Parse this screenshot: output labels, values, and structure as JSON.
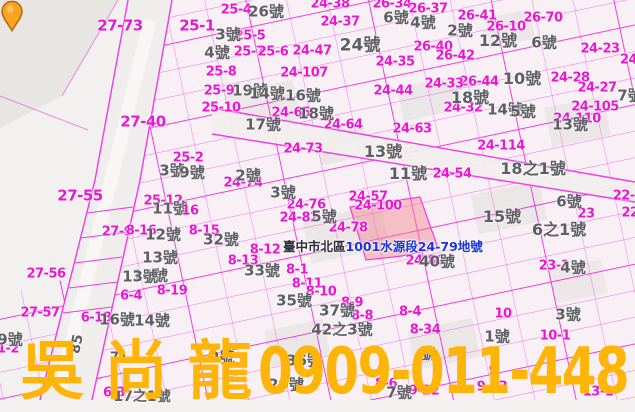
{
  "app": {
    "description": "cadastral map viewer"
  },
  "callout": {
    "prefix": "臺中市北區",
    "lot": "1001水源段24-79地號"
  },
  "watermark": {
    "name": "吳尚龍",
    "phone": "0909-011-448"
  },
  "colors": {
    "line": "#f23ae8",
    "street_line": "#ea21dc",
    "parcel_label": "#ec16d2",
    "house_label": "#5e5e64",
    "callout_blue": "#1a35da",
    "callout_dark": "#2c2c34",
    "watermark": "#ffb408",
    "pin_fill": "#f9a422",
    "pin_stroke": "#bf6708",
    "highlight_fill": "rgba(242,130,140,0.45)",
    "background": "#f3f1ef"
  },
  "map_labels": [
    {
      "t": "27-73",
      "x": 120,
      "y": 26,
      "c": "p",
      "s": 15
    },
    {
      "t": "25-1",
      "x": 197,
      "y": 26,
      "c": "p",
      "s": 15
    },
    {
      "t": "27-40",
      "x": 143,
      "y": 122,
      "c": "p",
      "s": 15
    },
    {
      "t": "27-55",
      "x": 80,
      "y": 196,
      "c": "p",
      "s": 15
    },
    {
      "t": "27-56",
      "x": 46,
      "y": 274,
      "c": "p"
    },
    {
      "t": "27-57",
      "x": 40,
      "y": 313,
      "c": "p"
    },
    {
      "t": "25-4",
      "x": 236,
      "y": 10,
      "c": "p"
    },
    {
      "t": "24-38",
      "x": 330,
      "y": 4,
      "c": "p"
    },
    {
      "t": "26-34",
      "x": 392,
      "y": 4,
      "c": "p"
    },
    {
      "t": "26-37",
      "x": 428,
      "y": 9,
      "c": "p"
    },
    {
      "t": "24-37",
      "x": 340,
      "y": 22,
      "c": "p"
    },
    {
      "t": "25-5",
      "x": 250,
      "y": 36,
      "c": "p"
    },
    {
      "t": "25-7",
      "x": 249,
      "y": 52,
      "c": "p"
    },
    {
      "t": "25-6",
      "x": 273,
      "y": 52,
      "c": "p"
    },
    {
      "t": "24-47",
      "x": 312,
      "y": 51,
      "c": "p"
    },
    {
      "t": "24-35",
      "x": 395,
      "y": 62,
      "c": "p"
    },
    {
      "t": "24-107",
      "x": 304,
      "y": 73,
      "c": "p"
    },
    {
      "t": "25-8",
      "x": 221,
      "y": 72,
      "c": "p"
    },
    {
      "t": "25-9",
      "x": 219,
      "y": 91,
      "c": "p"
    },
    {
      "t": "25-10",
      "x": 221,
      "y": 108,
      "c": "p"
    },
    {
      "t": "24-65",
      "x": 291,
      "y": 113,
      "c": "p"
    },
    {
      "t": "24-64",
      "x": 343,
      "y": 125,
      "c": "p"
    },
    {
      "t": "24-63",
      "x": 412,
      "y": 129,
      "c": "p"
    },
    {
      "t": "26-41",
      "x": 477,
      "y": 16,
      "c": "p"
    },
    {
      "t": "26-70",
      "x": 543,
      "y": 18,
      "c": "p"
    },
    {
      "t": "26-10",
      "x": 506,
      "y": 27,
      "c": "p"
    },
    {
      "t": "26-40",
      "x": 433,
      "y": 47,
      "c": "p"
    },
    {
      "t": "26-42",
      "x": 455,
      "y": 56,
      "c": "p"
    },
    {
      "t": "24-23",
      "x": 600,
      "y": 49,
      "c": "p"
    },
    {
      "t": "24-",
      "x": 631,
      "y": 60,
      "c": "p"
    },
    {
      "t": "24-44",
      "x": 393,
      "y": 91,
      "c": "p"
    },
    {
      "t": "26-44",
      "x": 479,
      "y": 82,
      "c": "p"
    },
    {
      "t": "24-28",
      "x": 570,
      "y": 78,
      "c": "p"
    },
    {
      "t": "24-27",
      "x": 597,
      "y": 88,
      "c": "p"
    },
    {
      "t": "24-33",
      "x": 444,
      "y": 84,
      "c": "p"
    },
    {
      "t": "24-32",
      "x": 463,
      "y": 108,
      "c": "p"
    },
    {
      "t": "24-105",
      "x": 595,
      "y": 107,
      "c": "p"
    },
    {
      "t": "24-110",
      "x": 577,
      "y": 119,
      "c": "p"
    },
    {
      "t": "24-73",
      "x": 303,
      "y": 149,
      "c": "p"
    },
    {
      "t": "24-114",
      "x": 501,
      "y": 146,
      "c": "p"
    },
    {
      "t": "25-2",
      "x": 188,
      "y": 158,
      "c": "p"
    },
    {
      "t": "27-9",
      "x": 117,
      "y": 232,
      "c": "p"
    },
    {
      "t": "8-15",
      "x": 204,
      "y": 231,
      "c": "p"
    },
    {
      "t": "8-16",
      "x": 141,
      "y": 231,
      "c": "p"
    },
    {
      "t": "25-12",
      "x": 163,
      "y": 201,
      "c": "p"
    },
    {
      "t": "24-54",
      "x": 452,
      "y": 174,
      "c": "p"
    },
    {
      "t": "24-74",
      "x": 243,
      "y": 183,
      "c": "p"
    },
    {
      "t": "24-57",
      "x": 368,
      "y": 197,
      "c": "p"
    },
    {
      "t": "24-100",
      "x": 378,
      "y": 206,
      "c": "p"
    },
    {
      "t": "24-76",
      "x": 306,
      "y": 205,
      "c": "p"
    },
    {
      "t": "24-82",
      "x": 299,
      "y": 218,
      "c": "p"
    },
    {
      "t": "24-78",
      "x": 348,
      "y": 228,
      "c": "p"
    },
    {
      "t": "24-80",
      "x": 425,
      "y": 261,
      "c": "p"
    },
    {
      "t": "23-1",
      "x": 554,
      "y": 266,
      "c": "p"
    },
    {
      "t": "23",
      "x": 586,
      "y": 214,
      "c": "p"
    },
    {
      "t": "22-6",
      "x": 628,
      "y": 196,
      "c": "p"
    },
    {
      "t": "22",
      "x": 630,
      "y": 213,
      "c": "p"
    },
    {
      "t": "8-12",
      "x": 265,
      "y": 250,
      "c": "p"
    },
    {
      "t": "8-13",
      "x": 243,
      "y": 261,
      "c": "p"
    },
    {
      "t": "8-1",
      "x": 297,
      "y": 270,
      "c": "p"
    },
    {
      "t": "8-11",
      "x": 307,
      "y": 284,
      "c": "p"
    },
    {
      "t": "8-10",
      "x": 321,
      "y": 292,
      "c": "p"
    },
    {
      "t": "8-9",
      "x": 352,
      "y": 303,
      "c": "p"
    },
    {
      "t": "8-8",
      "x": 362,
      "y": 316,
      "c": "p"
    },
    {
      "t": "8-4",
      "x": 410,
      "y": 312,
      "c": "p"
    },
    {
      "t": "8-34",
      "x": 425,
      "y": 330,
      "c": "p"
    },
    {
      "t": "8-19",
      "x": 172,
      "y": 291,
      "c": "p"
    },
    {
      "t": "6-4",
      "x": 131,
      "y": 296,
      "c": "p"
    },
    {
      "t": "6-18",
      "x": 96,
      "y": 318,
      "c": "p"
    },
    {
      "t": "6-3",
      "x": 114,
      "y": 393,
      "c": "p"
    },
    {
      "t": "1-2",
      "x": 8,
      "y": 349,
      "c": "p"
    },
    {
      "t": "10",
      "x": 503,
      "y": 314,
      "c": "p"
    },
    {
      "t": "10-1",
      "x": 555,
      "y": 336,
      "c": "p"
    },
    {
      "t": "9",
      "x": 493,
      "y": 371,
      "c": "p"
    },
    {
      "t": "9-23",
      "x": 492,
      "y": 387,
      "c": "p"
    },
    {
      "t": "13-1",
      "x": 598,
      "y": 392,
      "c": "p"
    },
    {
      "t": "8-6",
      "x": 386,
      "y": 384,
      "c": "p"
    },
    {
      "t": "9-22",
      "x": 424,
      "y": 391,
      "c": "p"
    },
    {
      "t": "26號",
      "x": 266,
      "y": 12,
      "c": "h"
    },
    {
      "t": "6號",
      "x": 396,
      "y": 18,
      "c": "h"
    },
    {
      "t": "4號",
      "x": 423,
      "y": 23,
      "c": "h"
    },
    {
      "t": "3號",
      "x": 228,
      "y": 35,
      "c": "h"
    },
    {
      "t": "4號",
      "x": 217,
      "y": 53,
      "c": "h"
    },
    {
      "t": "24號",
      "x": 360,
      "y": 46,
      "c": "h",
      "s": 17
    },
    {
      "t": "19號",
      "x": 250,
      "y": 91,
      "c": "h"
    },
    {
      "t": "14號",
      "x": 267,
      "y": 94,
      "c": "h"
    },
    {
      "t": "16號",
      "x": 303,
      "y": 96,
      "c": "h"
    },
    {
      "t": "18號",
      "x": 316,
      "y": 114,
      "c": "h"
    },
    {
      "t": "17號",
      "x": 263,
      "y": 125,
      "c": "h"
    },
    {
      "t": "2號",
      "x": 460,
      "y": 31,
      "c": "h"
    },
    {
      "t": "12號",
      "x": 498,
      "y": 41,
      "c": "h",
      "s": 16
    },
    {
      "t": "6號",
      "x": 544,
      "y": 43,
      "c": "h"
    },
    {
      "t": "10號",
      "x": 522,
      "y": 79,
      "c": "h",
      "s": 16
    },
    {
      "t": "18號",
      "x": 470,
      "y": 98,
      "c": "h",
      "s": 16
    },
    {
      "t": "14號",
      "x": 505,
      "y": 110,
      "c": "h"
    },
    {
      "t": "5號",
      "x": 523,
      "y": 112,
      "c": "h"
    },
    {
      "t": "7號",
      "x": 630,
      "y": 96,
      "c": "h"
    },
    {
      "t": "13號",
      "x": 570,
      "y": 125,
      "c": "h"
    },
    {
      "t": "13號",
      "x": 383,
      "y": 152,
      "c": "h",
      "s": 16
    },
    {
      "t": "11號",
      "x": 408,
      "y": 174,
      "c": "h",
      "s": 16
    },
    {
      "t": "18之1號",
      "x": 533,
      "y": 169,
      "c": "h",
      "s": 16
    },
    {
      "t": "2號",
      "x": 248,
      "y": 176,
      "c": "h"
    },
    {
      "t": "3號",
      "x": 283,
      "y": 193,
      "c": "h"
    },
    {
      "t": "3號",
      "x": 172,
      "y": 171,
      "c": "h"
    },
    {
      "t": "9號",
      "x": 192,
      "y": 173,
      "c": "h"
    },
    {
      "t": "11號",
      "x": 170,
      "y": 209,
      "c": "h"
    },
    {
      "t": "16",
      "x": 190,
      "y": 211,
      "c": "p"
    },
    {
      "t": "12號",
      "x": 163,
      "y": 235,
      "c": "h"
    },
    {
      "t": "13號",
      "x": 160,
      "y": 258,
      "c": "h"
    },
    {
      "t": "14號",
      "x": 150,
      "y": 276,
      "c": "h"
    },
    {
      "t": "32號",
      "x": 221,
      "y": 240,
      "c": "h"
    },
    {
      "t": "5號",
      "x": 324,
      "y": 217,
      "c": "h"
    },
    {
      "t": "6號",
      "x": 569,
      "y": 202,
      "c": "h"
    },
    {
      "t": "15號",
      "x": 502,
      "y": 217,
      "c": "h",
      "s": 16
    },
    {
      "t": "6之1號",
      "x": 559,
      "y": 230,
      "c": "h",
      "s": 16
    },
    {
      "t": "40號",
      "x": 437,
      "y": 262,
      "c": "h"
    },
    {
      "t": "33號",
      "x": 262,
      "y": 271,
      "c": "h"
    },
    {
      "t": "35號",
      "x": 294,
      "y": 301,
      "c": "h"
    },
    {
      "t": "37號",
      "x": 337,
      "y": 311,
      "c": "h"
    },
    {
      "t": "42之3號",
      "x": 342,
      "y": 330,
      "c": "h",
      "s": 15
    },
    {
      "t": "36號",
      "x": 304,
      "y": 361,
      "c": "h"
    },
    {
      "t": "29號",
      "x": 286,
      "y": 385,
      "c": "h"
    },
    {
      "t": "2號",
      "x": 222,
      "y": 358,
      "c": "h"
    },
    {
      "t": "16號",
      "x": 117,
      "y": 320,
      "c": "h"
    },
    {
      "t": "14號",
      "x": 152,
      "y": 321,
      "c": "h"
    },
    {
      "t": "13號",
      "x": 140,
      "y": 277,
      "c": "h"
    },
    {
      "t": "9號",
      "x": 10,
      "y": 340,
      "c": "h"
    },
    {
      "t": "71",
      "x": 119,
      "y": 358,
      "c": "h",
      "s": 13
    },
    {
      "t": "17之1號",
      "x": 142,
      "y": 397,
      "c": "h",
      "s": 14
    },
    {
      "t": "4號",
      "x": 573,
      "y": 268,
      "c": "h"
    },
    {
      "t": "3號",
      "x": 568,
      "y": 315,
      "c": "h"
    },
    {
      "t": "1號",
      "x": 497,
      "y": 337,
      "c": "h"
    },
    {
      "t": "號",
      "x": 428,
      "y": 354,
      "c": "h"
    },
    {
      "t": "85",
      "x": 77,
      "y": 344,
      "c": "h",
      "s": 14,
      "r": -78
    },
    {
      "t": "7號",
      "x": 399,
      "y": 393,
      "c": "h"
    }
  ]
}
